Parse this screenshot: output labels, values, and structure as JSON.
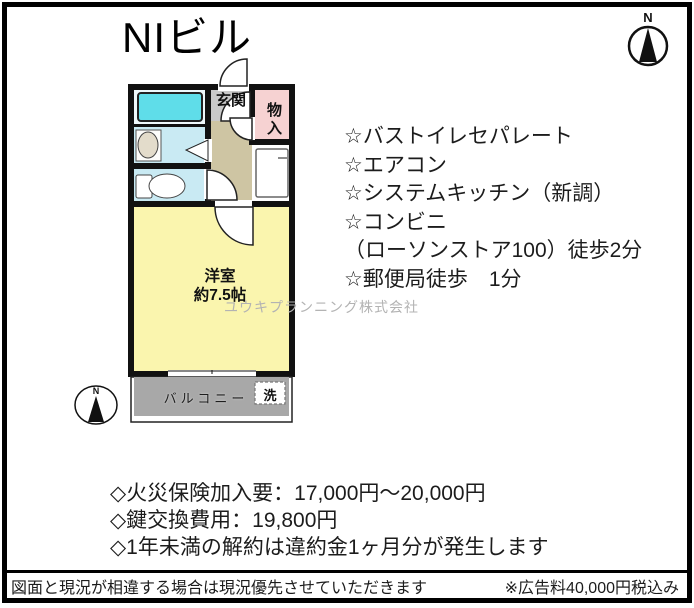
{
  "title": "NIビル",
  "compass": {
    "north_label": "N"
  },
  "floorplan": {
    "entrance_label": "玄関",
    "storage_label": "物入",
    "room_label": "洋室\n約7.5帖",
    "balcony_label": "バルコニー",
    "washer_label": "洗",
    "compass_north": "N"
  },
  "features": {
    "items": [
      "☆バストイレセパレート",
      "☆エアコン",
      "☆システムキッチン（新調）",
      "☆コンビニ",
      "（ローソンストア100）徒歩2分",
      "☆郵便局徒歩　1分"
    ]
  },
  "watermark": "ユウキプランニング株式会社",
  "notes": {
    "items": [
      "◇火災保険加入要：17,000円～20,000円",
      "◇鍵交換費用：19,800円",
      "◇1年未満の解約は違約金1ヶ月分が発生します"
    ]
  },
  "footer": {
    "disclaimer": "図面と現況が相違する場合は現況優先させていただきます",
    "ad_fee": "※広告料40,000円税込み"
  },
  "colors": {
    "wall": "#111111",
    "room_yellow": "#faf5ae",
    "bath_blue": "#c9eaf3",
    "bath_bg": "#eef8fb",
    "tub_cyan": "#5fdde9",
    "entrance_gray": "#c9c9c9",
    "hall_tan": "#cec5a3",
    "storage_pink": "#f6d2d2",
    "balcony_gray": "#a8a8a8"
  }
}
